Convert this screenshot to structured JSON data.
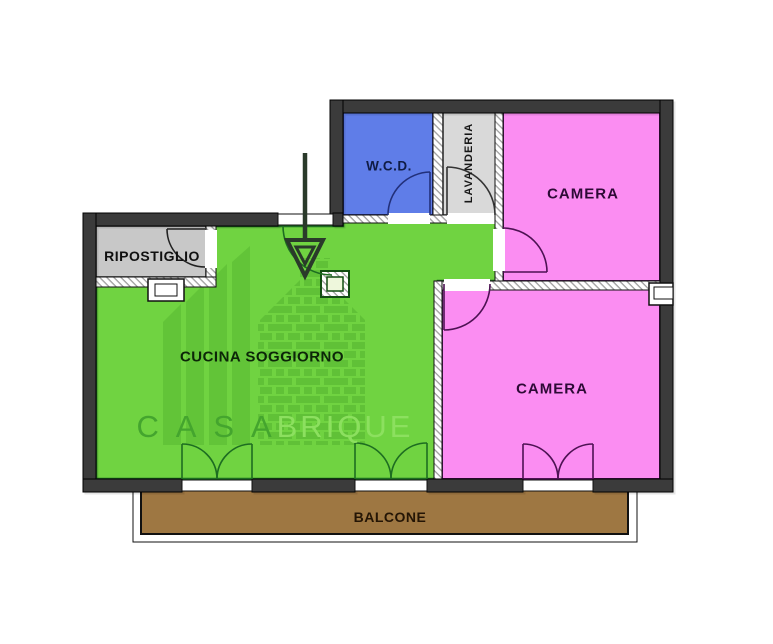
{
  "plan": {
    "rooms": {
      "ripostiglio": {
        "label": "RIPOSTIGLIO",
        "fill": "#c8c8c8"
      },
      "wcd": {
        "label": "W.C.D.",
        "fill": "#5f7de8"
      },
      "lavanderia": {
        "label": "LAVANDERIA",
        "fill": "#d9d9d9"
      },
      "camera_top": {
        "label": "CAMERA",
        "fill": "#fb8df2"
      },
      "camera_bottom": {
        "label": "CAMERA",
        "fill": "#fb8df2"
      },
      "cucina_soggiorno": {
        "label": "CUCINA SOGGIORNO",
        "fill": "#70d341"
      },
      "balcone": {
        "label": "BALCONE",
        "fill": "#9e7742"
      }
    },
    "watermark": {
      "brand_primary": "C A S A",
      "brand_secondary": "BRIQUE"
    }
  },
  "colors": {
    "wall": "#3b3b3b",
    "green": "#70d341",
    "green-border": "#1d6d21",
    "pink": "#fb8df2",
    "pink-border": "#4d1253",
    "blue": "#5f7de8",
    "blue-border": "#25307d",
    "gray-room": "#c8c8c8",
    "gray-light": "#d9d9d9",
    "brown": "#9e7742",
    "column-fill": "#eef7dc",
    "arrow": "#2a3a2a",
    "watermark-dark": "#44a52e",
    "watermark-light": "#8ce05f"
  }
}
